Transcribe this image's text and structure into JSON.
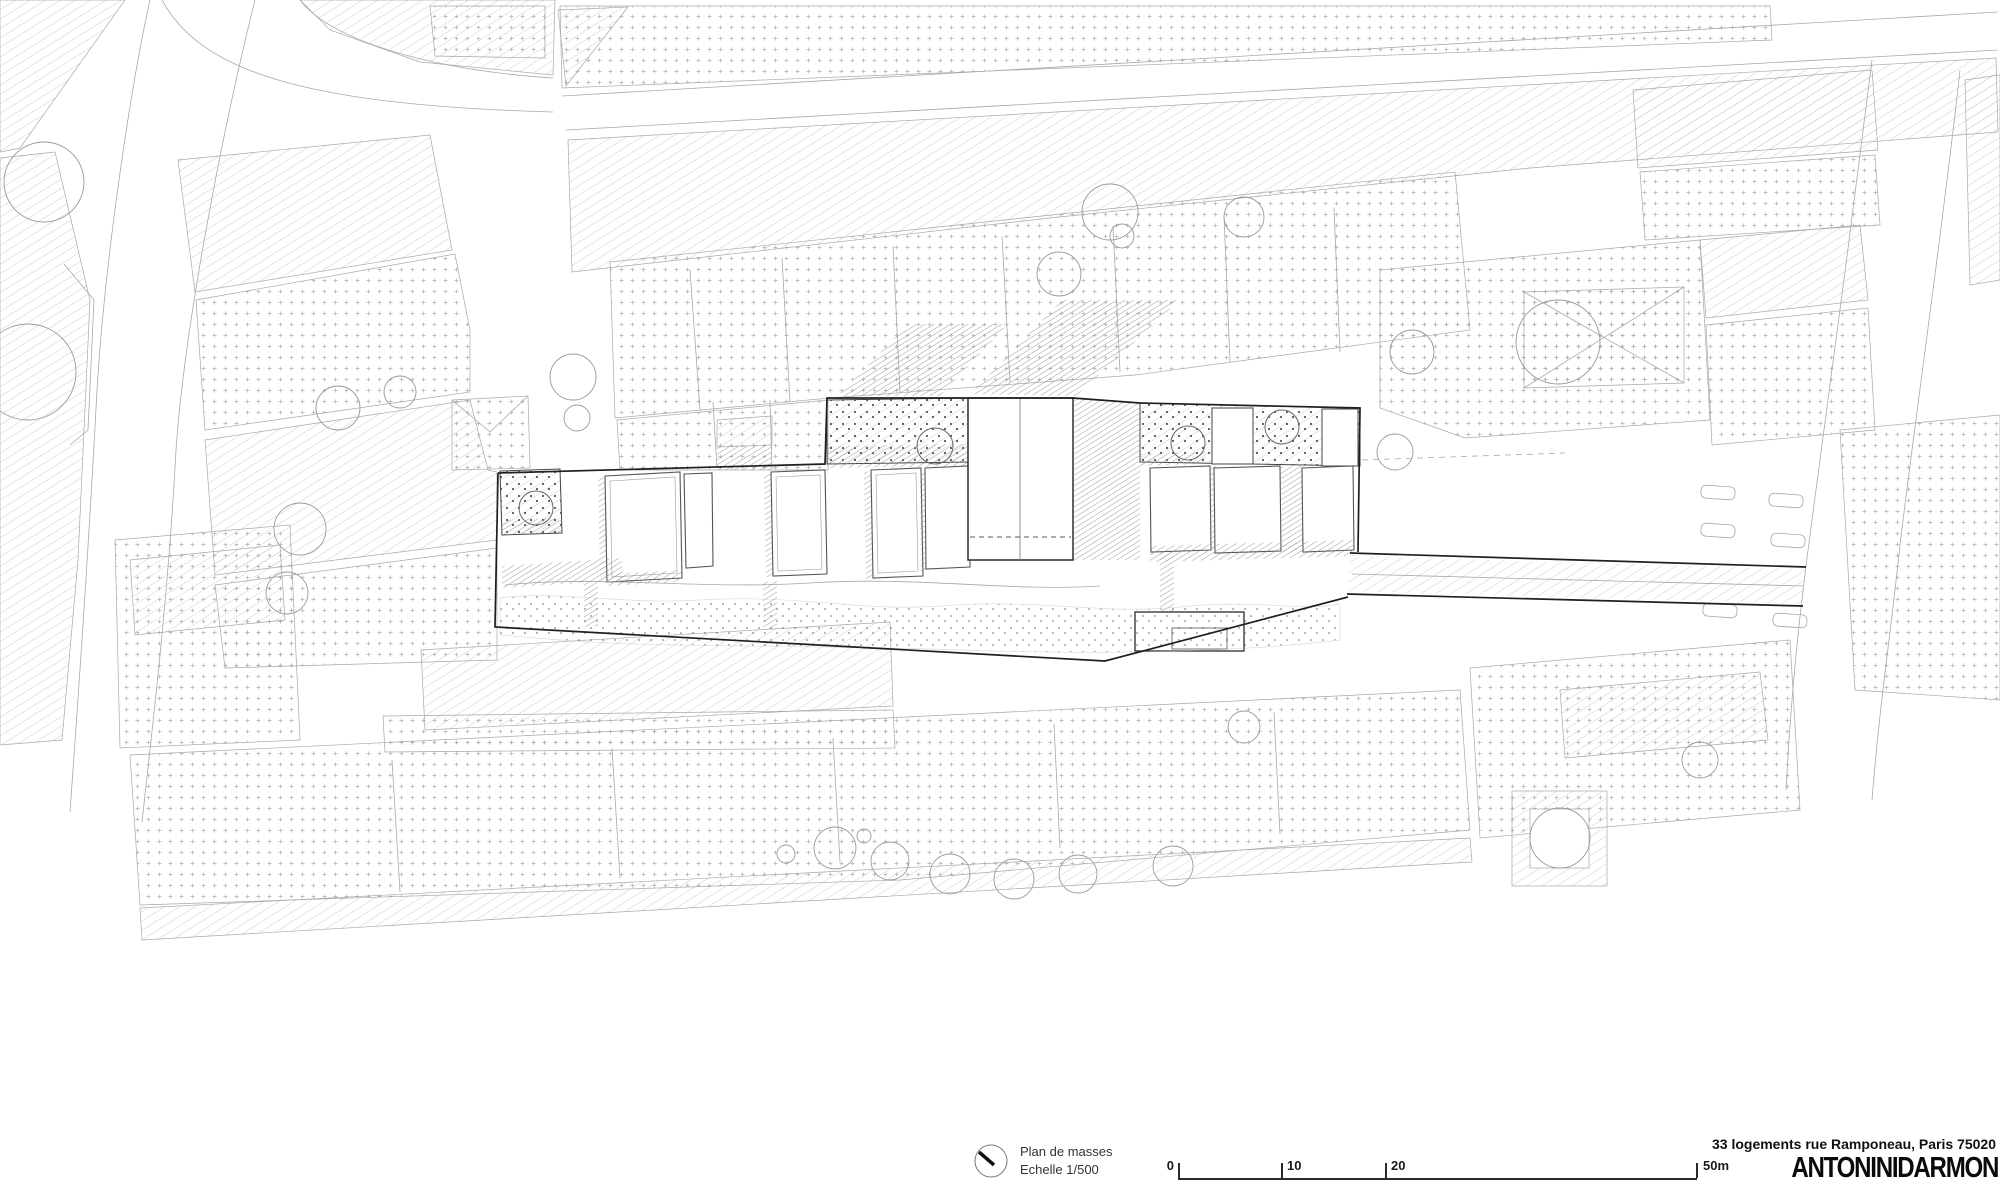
{
  "titleblock": {
    "drawing_title": "Plan de masses",
    "scale_label": "Echelle  1/500",
    "scale_bar": {
      "ticks": [
        "0",
        "10",
        "20",
        "50m"
      ]
    },
    "project_title": "33 logements rue Ramponeau, Paris 75020",
    "firm_logo": "ANTONINIDARMON",
    "north_icon": "north-arrow"
  },
  "map": {
    "kind": "architectural masterplan drawing",
    "colors": {
      "fabric_line": "#a8a8a8",
      "site_outline": "#1f1f1f",
      "shadow_hatch": "#909090",
      "paper": "#ffffff"
    }
  }
}
